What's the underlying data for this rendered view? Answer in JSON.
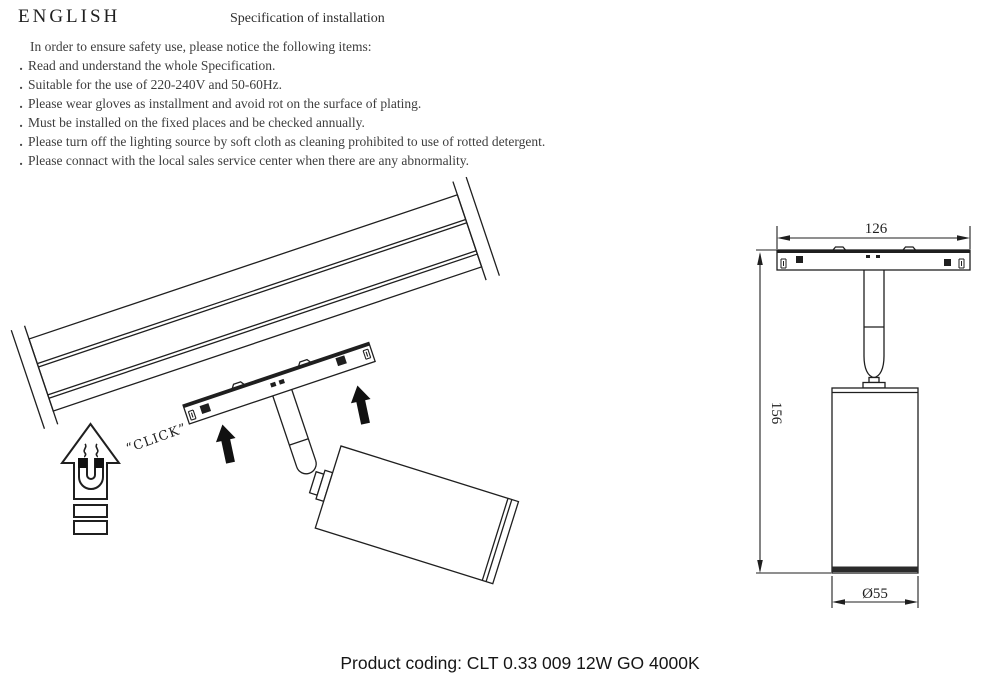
{
  "header": {
    "language_label": "ENGLISH",
    "title": "Specification of installation"
  },
  "instructions": {
    "intro": "In order to ensure safety use, please notice the following items:",
    "bullet": ".",
    "items": [
      "Read and understand the whole Specification.",
      "Suitable for the use of 220-240V and 50-60Hz.",
      "Please wear gloves as installment and avoid rot on the surface of plating.",
      "Must be installed on the fixed places and be checked annually.",
      "Please turn off the lighting source by soft cloth as cleaning prohibited to use of rotted detergent.",
      "Please connact with the local sales service center when there are any abnormality."
    ]
  },
  "installation_diagram": {
    "click_label": "“CLICK”"
  },
  "dimension_diagram": {
    "width_mm": "126",
    "height_mm": "156",
    "diameter_mm": "Ø55"
  },
  "footer": {
    "product_coding": "Product coding: CLT 0.33 009 12W GO 4000K"
  },
  "colors": {
    "line": "#1f1f1f",
    "body_text": "#3d3d3d"
  }
}
